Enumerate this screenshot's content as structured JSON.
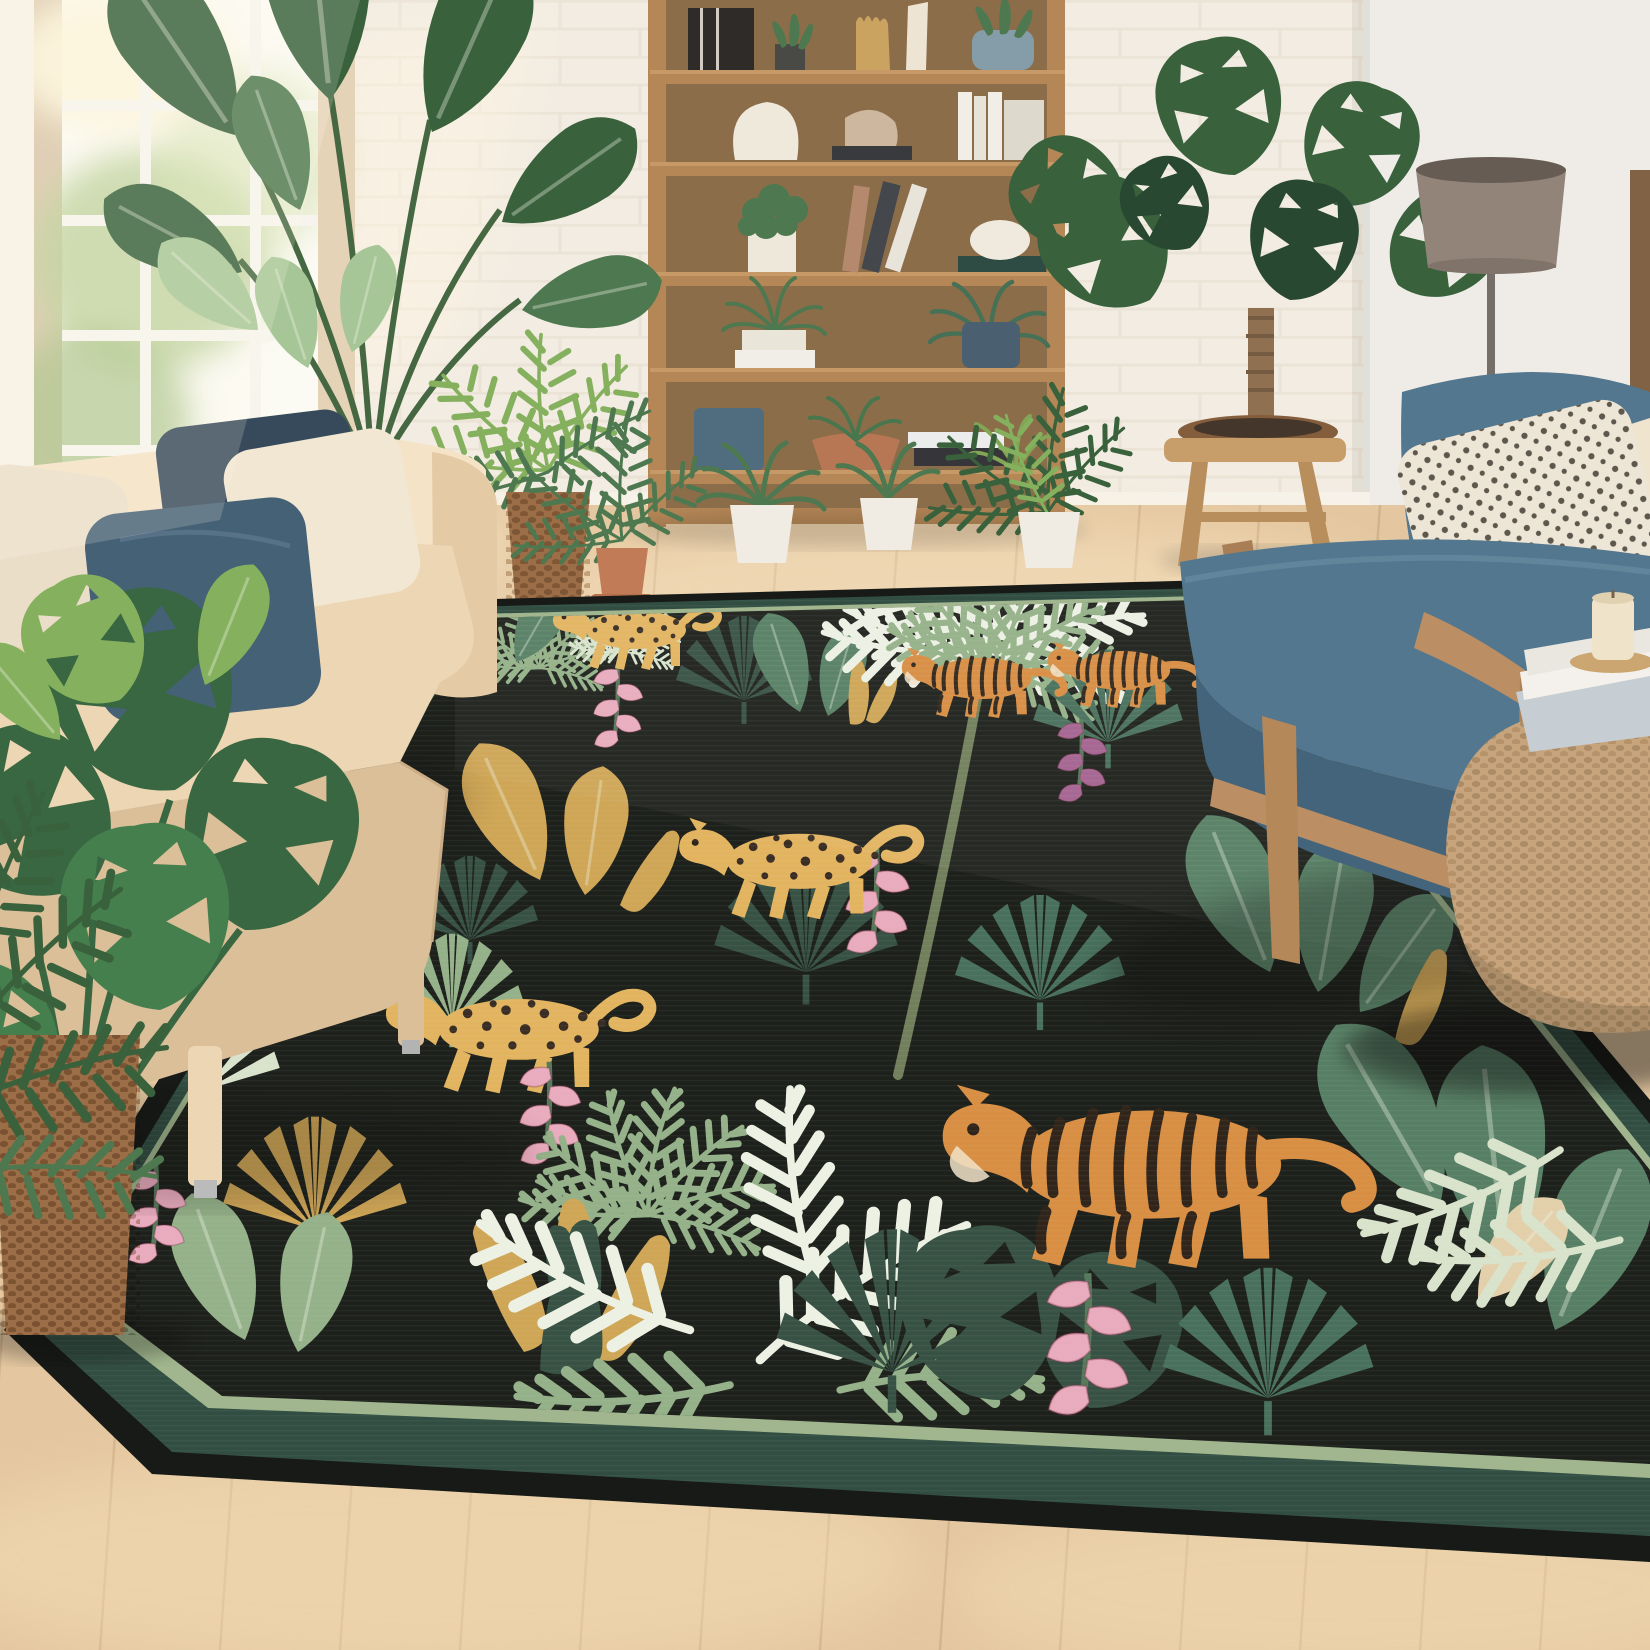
{
  "meta": {
    "kind": "natural-image",
    "description": "Product photo: black jungle-print area rug with tigers and leopards in a bright boho living room"
  },
  "palette": {
    "wall": "#f2ede2",
    "wallRight": "#efede7",
    "brickLine": "#e3dbca",
    "windowFrame": "#d8c5a8",
    "muntin": "#f7f5ef",
    "glass": "#fbfbf4",
    "glassGreen1": "#b4cc8e",
    "glassGreen2": "#9cba79",
    "floor": "#e3c69d",
    "floorDark": "#d2af83",
    "floorLight": "#f6e6c4",
    "floorSeam": "#c2a076",
    "shelfWood": "#b1824f",
    "shelfWoodDark": "#8e6336",
    "shelfBack": "#99764c",
    "sofa": "#ecd5b0",
    "sofaShadow": "#d9bd95",
    "sofaLight": "#f4e3c5",
    "pillowCream": "#f1e7d2",
    "pillowNavy": "#3c5a70",
    "pillowNavyDark": "#2c4254",
    "chairTeal": "#4a7189",
    "chairTealDark": "#3a5d75",
    "chairWood": "#b98a5c",
    "poufJute": "#c4a176",
    "poufJuteDark": "#9a7850",
    "lampShade": "#8d7f73",
    "lampShadeDark": "#5f554c",
    "lampPole": "#6e6862",
    "stoolWood": "#c59a63",
    "terracotta": "#bf7550",
    "whitePot": "#f0ede3",
    "basketBrown": "#96683f",
    "plantDark": "#2e5a33",
    "plantMid": "#457247",
    "plantLight": "#7fae57",
    "plantPale": "#a3c493",
    "rugBlack": "#121611",
    "rugEdgeDark": "#0b0f0b",
    "rugBorderSage": "#9cb489",
    "rugBorderBand": "#27463a",
    "rugLeafDark": "#2d4a3c",
    "rugLeafMid": "#4f7a5e",
    "rugLeafSage": "#8fae84",
    "rugLeafPale": "#d7e3cb",
    "rugLeafWhite": "#ecf2e4",
    "rugLeafGold": "#cda24e",
    "rugLeafTeal": "#3f6a55",
    "rugLeafOlive": "#a8b55e",
    "tigerOrange": "#d6893a",
    "tigerStripe": "#261b10",
    "leopardGold": "#e2b259",
    "leopardSpot": "#2f231a",
    "flowerPink": "#e8a8bc",
    "flowerPurple": "#a05c8c"
  },
  "scene": {
    "room": {
      "wall": "white painted brick",
      "floor": "light oak plank",
      "light": "sunlight from window at left"
    },
    "furniture": [
      {
        "name": "sofa",
        "desc": "beige 3-seat sofa with cream and navy pillows",
        "position": "left"
      },
      {
        "name": "bookshelf",
        "desc": "tall oak bookshelf with books, vases and potted plants",
        "position": "center back"
      },
      {
        "name": "armchair",
        "desc": "teal-blue armchair with wooden frame and dotted pillow",
        "position": "right"
      },
      {
        "name": "floor-lamp",
        "desc": "gray drum-shade floor lamp",
        "position": "right back"
      },
      {
        "name": "stool",
        "desc": "wooden stool holding a monstera bowl",
        "position": "right of shelf"
      },
      {
        "name": "jute-pouf",
        "desc": "woven jute pouf side table with books and a candle",
        "position": "bottom right"
      }
    ],
    "plants": [
      "bird-of-paradise by the window",
      "calathea by the window",
      "palm in jute basket",
      "palm in terracotta pot",
      "spider plants in white pots",
      "boston fern in white pot",
      "monstera in woven basket (foreground left)",
      "palm fronds (foreground left)",
      "monstera on stool"
    ],
    "rug": {
      "style": "jungle botanical print",
      "field_color": "black",
      "border": [
        "thin sage-green line",
        "dark green band",
        "black outer edge"
      ],
      "animals": [
        {
          "type": "leopard",
          "position": "top left",
          "pose": "prowling left"
        },
        {
          "type": "tiger",
          "position": "upper middle",
          "pose": "walking left"
        },
        {
          "type": "tiger",
          "position": "upper right, behind armchair",
          "pose": "partial"
        },
        {
          "type": "leopard",
          "position": "center",
          "pose": "stalking left"
        },
        {
          "type": "leopard",
          "position": "middle left",
          "pose": "prowling left"
        },
        {
          "type": "tiger",
          "position": "bottom center",
          "pose": "walking left",
          "size": "large"
        }
      ],
      "flora": [
        "palm trees",
        "fan palms",
        "banana leaves",
        "monstera leaves",
        "pink heliconia flowers",
        "golden dracaena",
        "white ferns"
      ]
    }
  }
}
